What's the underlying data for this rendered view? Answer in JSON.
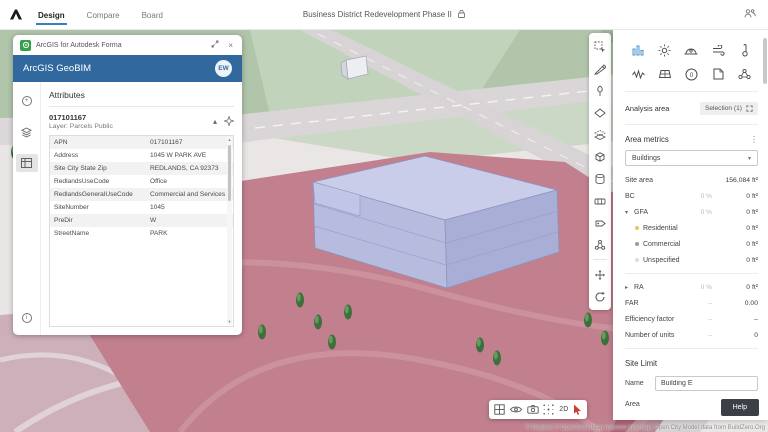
{
  "topbar": {
    "tabs": [
      {
        "label": "Design",
        "active": true
      },
      {
        "label": "Compare",
        "active": false
      },
      {
        "label": "Board",
        "active": false
      }
    ],
    "title": "Business District Redevelopment Phase II"
  },
  "geobim_panel": {
    "window_title": "ArcGIS for Autodesk Forma",
    "header_title": "ArcGIS GeoBIM",
    "avatar_initials": "EW",
    "section_title": "Attributes",
    "feature_id": "017101167",
    "layer_label": "Layer: Parcels Public",
    "attributes": [
      {
        "key": "APN",
        "value": "017101167"
      },
      {
        "key": "Address",
        "value": "1045 W PARK AVE"
      },
      {
        "key": "Site City State Zip",
        "value": "REDLANDS, CA 92373"
      },
      {
        "key": "RedlandsUseCode",
        "value": "Office"
      },
      {
        "key": "RedlandsGeneralUseCode",
        "value": "Commercial and Services"
      },
      {
        "key": "SiteNumber",
        "value": "1045"
      },
      {
        "key": "PreDir",
        "value": "W"
      },
      {
        "key": "StreetName",
        "value": "PARK"
      }
    ]
  },
  "right_panel": {
    "analysis_area_label": "Analysis area",
    "selection_button_label": "Selection (1)",
    "area_metrics_title": "Area metrics",
    "dropdown_value": "Buildings",
    "metrics": [
      {
        "label": "Site area",
        "mid": "",
        "value": "156,084 ft²"
      },
      {
        "label": "BC",
        "mid": "0 %",
        "value": "0 ft²"
      },
      {
        "label": "GFA",
        "mid": "0 %",
        "value": "0 ft²"
      },
      {
        "label": "Residential",
        "mid": "",
        "value": "0 ft²"
      },
      {
        "label": "Commercial",
        "mid": "",
        "value": "0 ft²"
      },
      {
        "label": "Unspecified",
        "mid": "",
        "value": "0 ft²"
      },
      {
        "label": "RA",
        "mid": "0 %",
        "value": "0 ft²"
      },
      {
        "label": "FAR",
        "mid": "–",
        "value": "0.00"
      },
      {
        "label": "Efficiency factor",
        "mid": "–",
        "value": "–"
      },
      {
        "label": "Number of units",
        "mid": "–",
        "value": "0"
      }
    ],
    "legend_colors": {
      "residential": "#d6cc62",
      "commercial": "#9b9b9b",
      "unspecified": "#dcdcdc"
    },
    "site_limit": {
      "title": "Site Limit",
      "name_label": "Name",
      "name_value": "Building E",
      "area_label": "Area",
      "area_value": "156084.4 ft²"
    },
    "help_button_label": "Help"
  },
  "viewport": {
    "mode_2d_label": "2D",
    "attribution": "© Mapbox  © OpenStreetMap  Improve this map.  Open City Model data from BuildZero.Org"
  },
  "icon_names": {
    "right_panel_grid": [
      "area-metrics",
      "sun",
      "daylight-potential",
      "wind",
      "thermal-comfort",
      "noise",
      "solar-energy",
      "embodied-carbon",
      "export",
      "connect"
    ],
    "vertical_toolbar": [
      "select",
      "draw-road",
      "vegetation",
      "site-limit",
      "zoning",
      "building",
      "geometry",
      "parking",
      "annotation",
      "group",
      "move",
      "rotate"
    ],
    "bottom_toolbar": [
      "layout-window",
      "visibility",
      "camera",
      "zoom-fit",
      "2d-toggle",
      "select-cursor"
    ]
  },
  "colors": {
    "accent_blue": "#3c7fb7",
    "geobim_header_blue": "#31699e",
    "arcgis_green": "#35a04b",
    "selected_parcel": "#c27f8e",
    "building_top": "#c9cdea"
  }
}
